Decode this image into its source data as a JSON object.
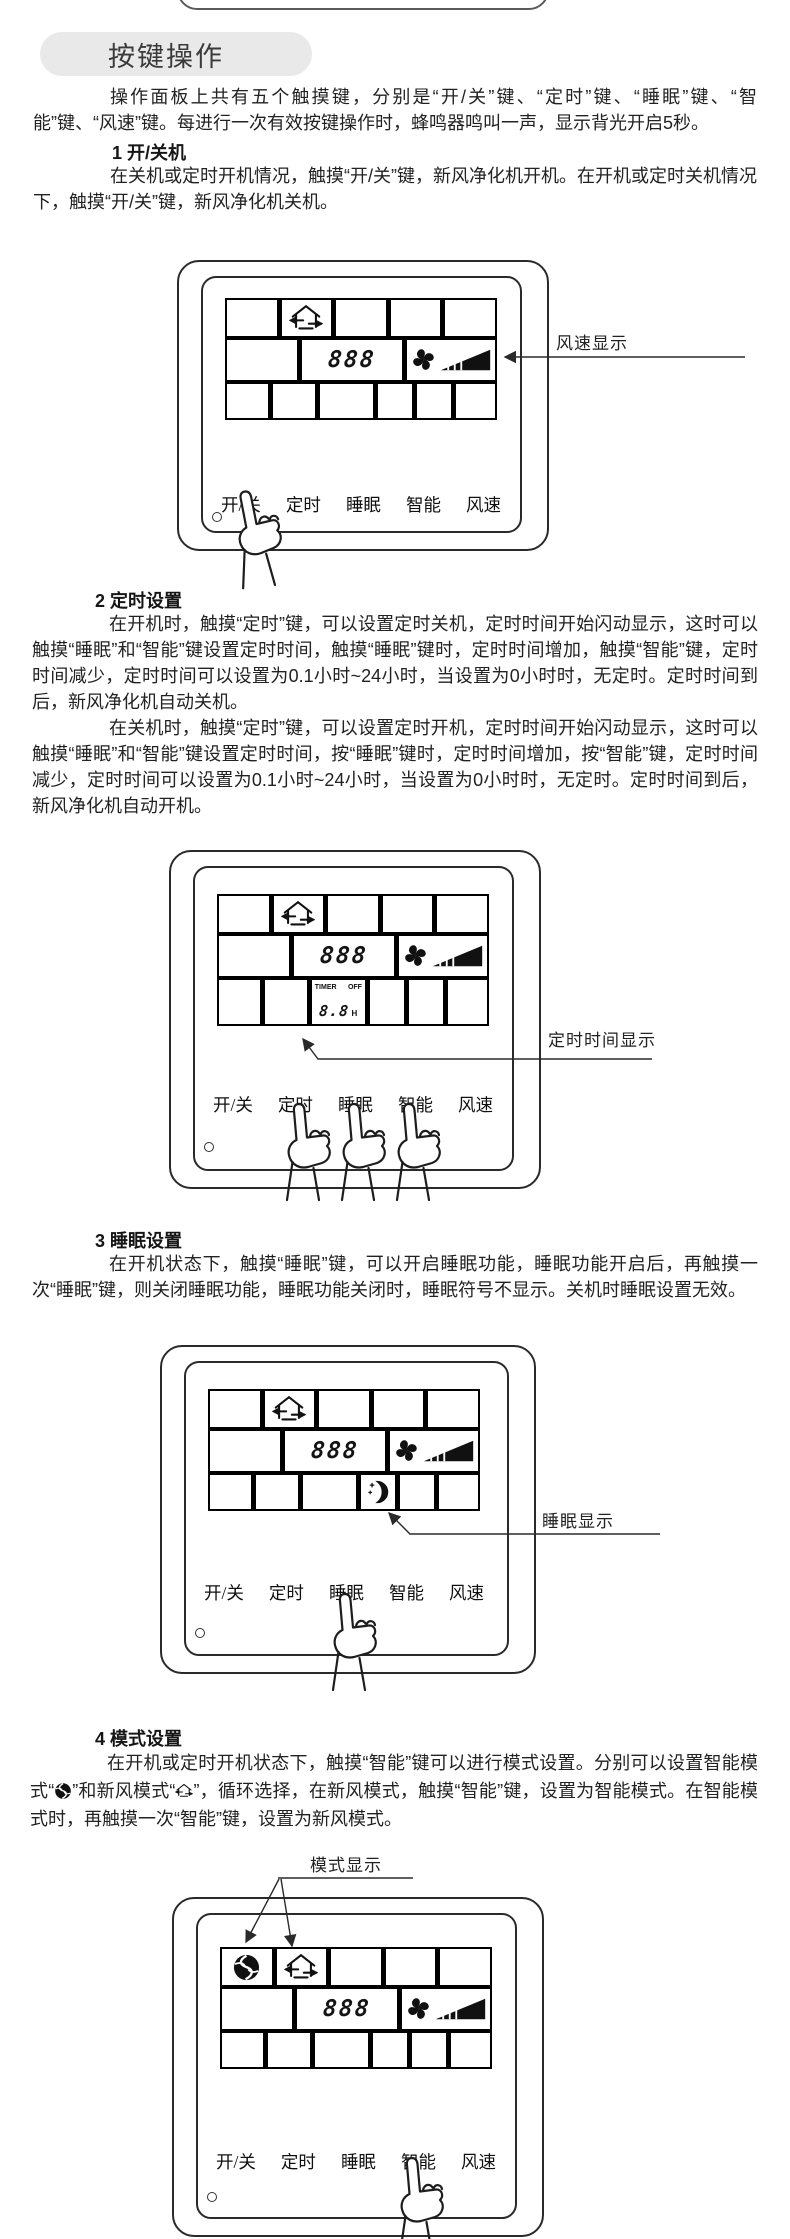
{
  "header": {
    "title": "按键操作"
  },
  "intro": "操作面板上共有五个触摸键，分别是“开/关”键、“定时”键、“睡眠”键、“智能”键、“风速”键。每进行一次有效按键操作时，蜂鸣器鸣叫一声，显示背光开启5秒。",
  "sections": [
    {
      "title": "1 开/关机",
      "p1": "在关机或定时开机情况，触摸“开/关”键，新风净化机开机。在开机或定时关机情况下，触摸“开/关”键，新风净化机关机。"
    },
    {
      "title": "2 定时设置",
      "p1": "在开机时，触摸“定时”键，可以设置定时关机，定时时间开始闪动显示，这时可以触摸“睡眠”和“智能”键设置定时时间，触摸“睡眠”键时，定时时间增加，触摸“智能”键，定时时间减少，定时时间可以设置为0.1小时~24小时，当设置为0小时时，无定时。定时时间到后，新风净化机自动关机。",
      "p2": "在关机时，触摸“定时”键，可以设置定时开机，定时时间开始闪动显示，这时可以触摸“睡眠”和“智能”键设置定时时间，按“睡眠”键时，定时时间增加，按“智能”键，定时时间减少，定时时间可以设置为0.1小时~24小时，当设置为0小时时，无定时。定时时间到后，新风净化机自动开机。"
    },
    {
      "title": "3 睡眠设置",
      "p1": "在开机状态下，触摸“睡眠”键，可以开启睡眠功能，睡眠功能开启后，再触摸一次“睡眠”键，则关闭睡眠功能，睡眠功能关闭时，睡眠符号不显示。关机时睡眠设置无效。"
    },
    {
      "title": "4 模式设置",
      "body_parts": [
        "在开机或定时开机状态下，触摸“智能”键可以进行模式设置。分别可以设置智能模式“",
        "”和新风模式“",
        "”，循环选择，在新风模式，触摸“智能”键，设置为智能模式。在智能模式时，再触摸一次“智能”键，设置为新风模式。"
      ]
    }
  ],
  "panel": {
    "display_digits": "888",
    "buttons": [
      "开/关",
      "定时",
      "睡眠",
      "智能",
      "风速"
    ],
    "timer": {
      "label": "TIMER",
      "state": "OFF",
      "digits": "8.8",
      "unit": "H"
    },
    "icons": {
      "fresh_air_mode": "house-fresh-air-icon",
      "smart_mode": "smart-mode-icon",
      "sleep": "crescent-moon-icon",
      "fan_speed": "fan-speed-icon",
      "hand": "pointing-hand-icon"
    }
  },
  "figures": [
    {
      "annotation": "风速显示"
    },
    {
      "annotation": "定时时间显示"
    },
    {
      "annotation": "睡眠显示"
    },
    {
      "annotation": "模式显示"
    }
  ],
  "colors": {
    "text": "#1f1f1f",
    "pill_bg": "#e9e9e9",
    "line": "#333333"
  }
}
